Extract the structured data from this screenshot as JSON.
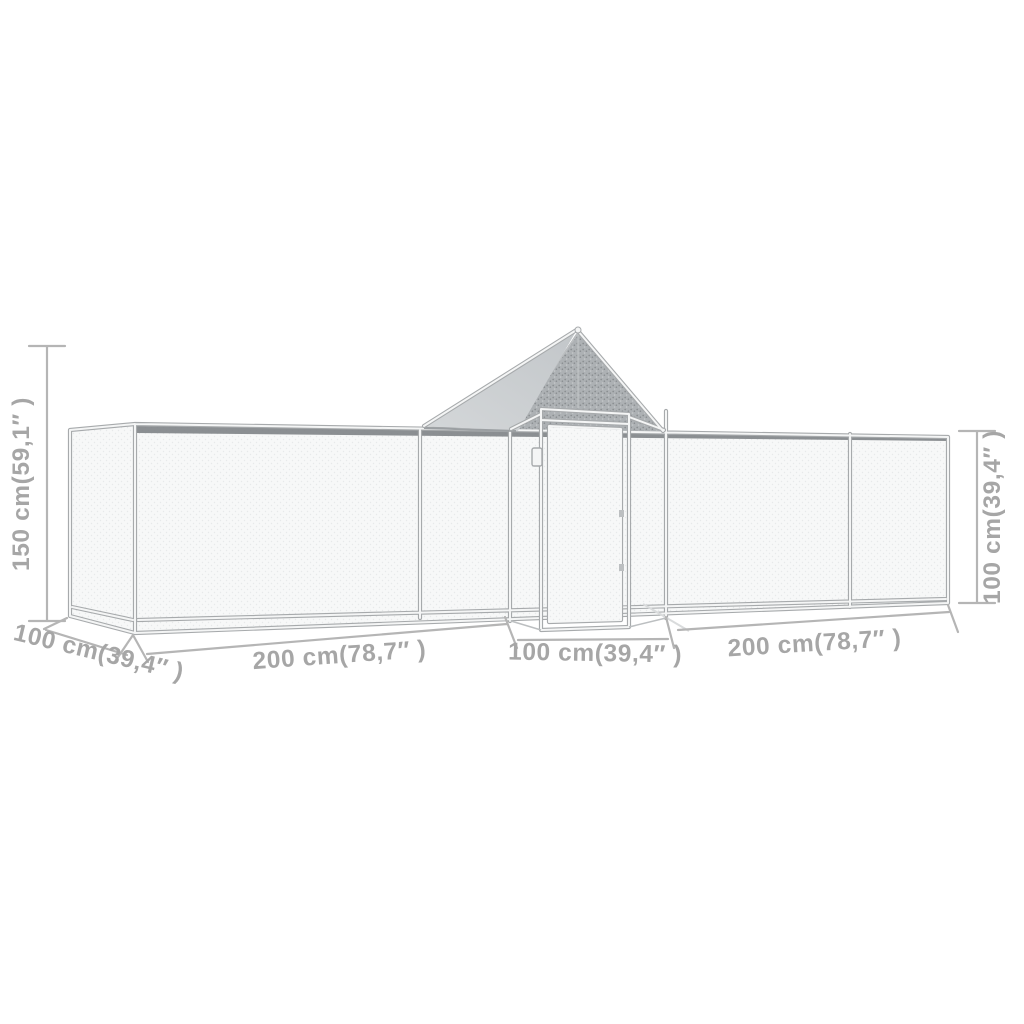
{
  "figure": {
    "kind": "product-dimension-diagram",
    "subject": "chicken-coop-run-with-gable-roof-and-door"
  },
  "annotations": {
    "height_left": "150 cm(59,1″ )",
    "height_right": "100 cm(39,4″ )",
    "depth_front_left": "100 cm(39,4″ )",
    "width_section_left": "200 cm(78,7″ )",
    "width_section_center": "100 cm(39,4″ )",
    "width_section_right": "200 cm(78,7″ )"
  },
  "colors": {
    "background": "#ffffff",
    "dimension_text": "#a6a6a6",
    "dimension_line": "#b5b5b5",
    "frame_stroke": "#a7aaac",
    "frame_fill": "#f4f5f5",
    "frame_thin": "#bcbfc1",
    "wall_mesh": "#f7f8f8",
    "wall_speckle": "#e7e9ea",
    "gable_mesh": "#adb1b4",
    "gable_speckle": "#8a8e91",
    "gable_speckle_light": "#c6c9cb",
    "tarp": "#c2c6c9",
    "tarp_light": "#d4d7d9",
    "roof_band": "#7c8083",
    "eave_shadow": "#9b9fa2",
    "ground_shadow": "#d9dbdc"
  }
}
